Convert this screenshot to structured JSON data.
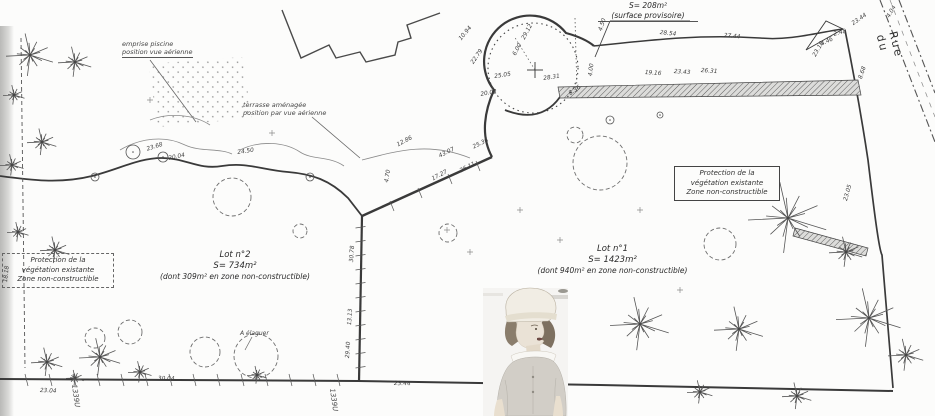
{
  "plan": {
    "provisional_area": {
      "line1": "S= 208m²",
      "line2": "(surface provisoire)"
    },
    "lot2": {
      "title": "Lot n°2",
      "area": "S= 734m²",
      "note": "(dont 309m² en zone non-constructible)"
    },
    "lot1": {
      "title": "Lot n°1",
      "area": "S= 1423m²",
      "note": "(dont 940m² en zone non-constructible)"
    },
    "protection_left": {
      "line1": "Protection de la",
      "line2": "végétation existante",
      "line3": "Zone non-constructible"
    },
    "protection_right": {
      "line1": "Protection de la",
      "line2": "végétation existante",
      "line3": "Zone non-constructible"
    },
    "pool_note": {
      "line1": "emprise piscine",
      "line2": "position vue aérienne"
    },
    "terrace_note": {
      "line1": "terrasse aménagée",
      "line2": "position par vue aérienne"
    },
    "prune_note": "A élaguer",
    "street_name": "Rue du",
    "parcel_labels": [
      {
        "text": "1339U",
        "x": 78,
        "y": 384
      },
      {
        "text": "1339U",
        "x": 336,
        "y": 388
      }
    ]
  },
  "colors": {
    "ink": "#2f2f2f",
    "faint": "#777777",
    "paper": "#fcfcfb"
  },
  "measurements": [
    {
      "t": "29.12",
      "x": 521,
      "y": 38,
      "r": -62
    },
    {
      "t": "6.00",
      "x": 512,
      "y": 54,
      "r": -62
    },
    {
      "t": "25.05",
      "x": 494,
      "y": 74,
      "r": -8
    },
    {
      "t": "28.31",
      "x": 543,
      "y": 76,
      "r": -8
    },
    {
      "t": "4.50",
      "x": 598,
      "y": 30,
      "r": -72
    },
    {
      "t": "4.00",
      "x": 588,
      "y": 76,
      "r": -84
    },
    {
      "t": "8.36",
      "x": 568,
      "y": 92,
      "r": -35
    },
    {
      "t": "28.54",
      "x": 660,
      "y": 30,
      "r": 6
    },
    {
      "t": "27.44",
      "x": 724,
      "y": 33,
      "r": 5
    },
    {
      "t": "19.16",
      "x": 645,
      "y": 70,
      "r": 4
    },
    {
      "t": "23.43",
      "x": 674,
      "y": 69,
      "r": 4
    },
    {
      "t": "26.31",
      "x": 701,
      "y": 68,
      "r": 4
    },
    {
      "t": "23.44",
      "x": 851,
      "y": 22,
      "r": -35
    },
    {
      "t": "2.48",
      "x": 833,
      "y": 32,
      "r": -15
    },
    {
      "t": "4.46",
      "x": 820,
      "y": 42,
      "r": -25
    },
    {
      "t": "23.18",
      "x": 812,
      "y": 55,
      "r": -60
    },
    {
      "t": "8.68",
      "x": 858,
      "y": 78,
      "r": -72
    },
    {
      "t": "23.05",
      "x": 843,
      "y": 200,
      "r": -74
    },
    {
      "t": "4.04",
      "x": 886,
      "y": 16,
      "r": -60
    },
    {
      "t": "12.86",
      "x": 396,
      "y": 143,
      "r": -28
    },
    {
      "t": "43.07",
      "x": 438,
      "y": 154,
      "r": -26
    },
    {
      "t": "25.36",
      "x": 472,
      "y": 145,
      "r": -26
    },
    {
      "t": "17.27",
      "x": 431,
      "y": 177,
      "r": -28
    },
    {
      "t": "26.11",
      "x": 459,
      "y": 169,
      "r": -28
    },
    {
      "t": "4.70",
      "x": 384,
      "y": 182,
      "r": -80
    },
    {
      "t": "30.78",
      "x": 349,
      "y": 262,
      "r": -86
    },
    {
      "t": "13.13",
      "x": 347,
      "y": 325,
      "r": -86
    },
    {
      "t": "29.40",
      "x": 345,
      "y": 358,
      "r": -86
    },
    {
      "t": "23.04",
      "x": 40,
      "y": 388,
      "r": 2
    },
    {
      "t": "30.04",
      "x": 158,
      "y": 376,
      "r": 1
    },
    {
      "t": "23.44",
      "x": 394,
      "y": 381,
      "r": 1
    },
    {
      "t": "18.18",
      "x": 3,
      "y": 282,
      "r": -84
    },
    {
      "t": "23.68",
      "x": 146,
      "y": 147,
      "r": -18
    },
    {
      "t": "20.04",
      "x": 168,
      "y": 156,
      "r": -12
    },
    {
      "t": "24.50",
      "x": 237,
      "y": 150,
      "r": -8
    },
    {
      "t": "10.94",
      "x": 458,
      "y": 38,
      "r": -50
    },
    {
      "t": "22.79",
      "x": 470,
      "y": 62,
      "r": -55
    },
    {
      "t": "20.02",
      "x": 480,
      "y": 92,
      "r": -10
    }
  ],
  "vegetation": {
    "star_trees": [
      {
        "x": 30,
        "y": 55,
        "r": 24
      },
      {
        "x": 75,
        "y": 62,
        "r": 17
      },
      {
        "x": 14,
        "y": 95,
        "r": 11
      },
      {
        "x": 42,
        "y": 142,
        "r": 15
      },
      {
        "x": 12,
        "y": 165,
        "r": 12
      },
      {
        "x": 55,
        "y": 250,
        "r": 15
      },
      {
        "x": 18,
        "y": 232,
        "r": 11
      },
      {
        "x": 100,
        "y": 357,
        "r": 21
      },
      {
        "x": 47,
        "y": 362,
        "r": 16
      },
      {
        "x": 140,
        "y": 372,
        "r": 12
      },
      {
        "x": 788,
        "y": 218,
        "r": 40
      },
      {
        "x": 846,
        "y": 252,
        "r": 17
      },
      {
        "x": 640,
        "y": 324,
        "r": 30
      },
      {
        "x": 739,
        "y": 329,
        "r": 25
      },
      {
        "x": 869,
        "y": 318,
        "r": 33
      },
      {
        "x": 906,
        "y": 355,
        "r": 18
      },
      {
        "x": 700,
        "y": 392,
        "r": 13
      },
      {
        "x": 797,
        "y": 396,
        "r": 15
      },
      {
        "x": 257,
        "y": 375,
        "r": 10
      },
      {
        "x": 75,
        "y": 378,
        "r": 9
      }
    ],
    "bush_clouds": [
      {
        "x": 232,
        "y": 197,
        "r": 19
      },
      {
        "x": 600,
        "y": 163,
        "r": 27
      },
      {
        "x": 720,
        "y": 244,
        "r": 16
      },
      {
        "x": 256,
        "y": 356,
        "r": 22
      },
      {
        "x": 205,
        "y": 352,
        "r": 15
      },
      {
        "x": 130,
        "y": 332,
        "r": 12
      },
      {
        "x": 95,
        "y": 338,
        "r": 10
      },
      {
        "x": 448,
        "y": 233,
        "r": 9
      },
      {
        "x": 300,
        "y": 231,
        "r": 7
      },
      {
        "x": 575,
        "y": 135,
        "r": 8
      }
    ],
    "small_circles": [
      {
        "x": 133,
        "y": 152,
        "r": 7
      },
      {
        "x": 163,
        "y": 157,
        "r": 5
      },
      {
        "x": 95,
        "y": 177,
        "r": 4
      },
      {
        "x": 310,
        "y": 177,
        "r": 4
      },
      {
        "x": 610,
        "y": 120,
        "r": 4
      },
      {
        "x": 660,
        "y": 115,
        "r": 3
      }
    ],
    "plus_marks": [
      {
        "x": 272,
        "y": 133
      },
      {
        "x": 447,
        "y": 230
      },
      {
        "x": 470,
        "y": 252
      },
      {
        "x": 520,
        "y": 210
      },
      {
        "x": 640,
        "y": 210
      },
      {
        "x": 560,
        "y": 240
      },
      {
        "x": 150,
        "y": 100
      },
      {
        "x": 680,
        "y": 290
      }
    ]
  }
}
